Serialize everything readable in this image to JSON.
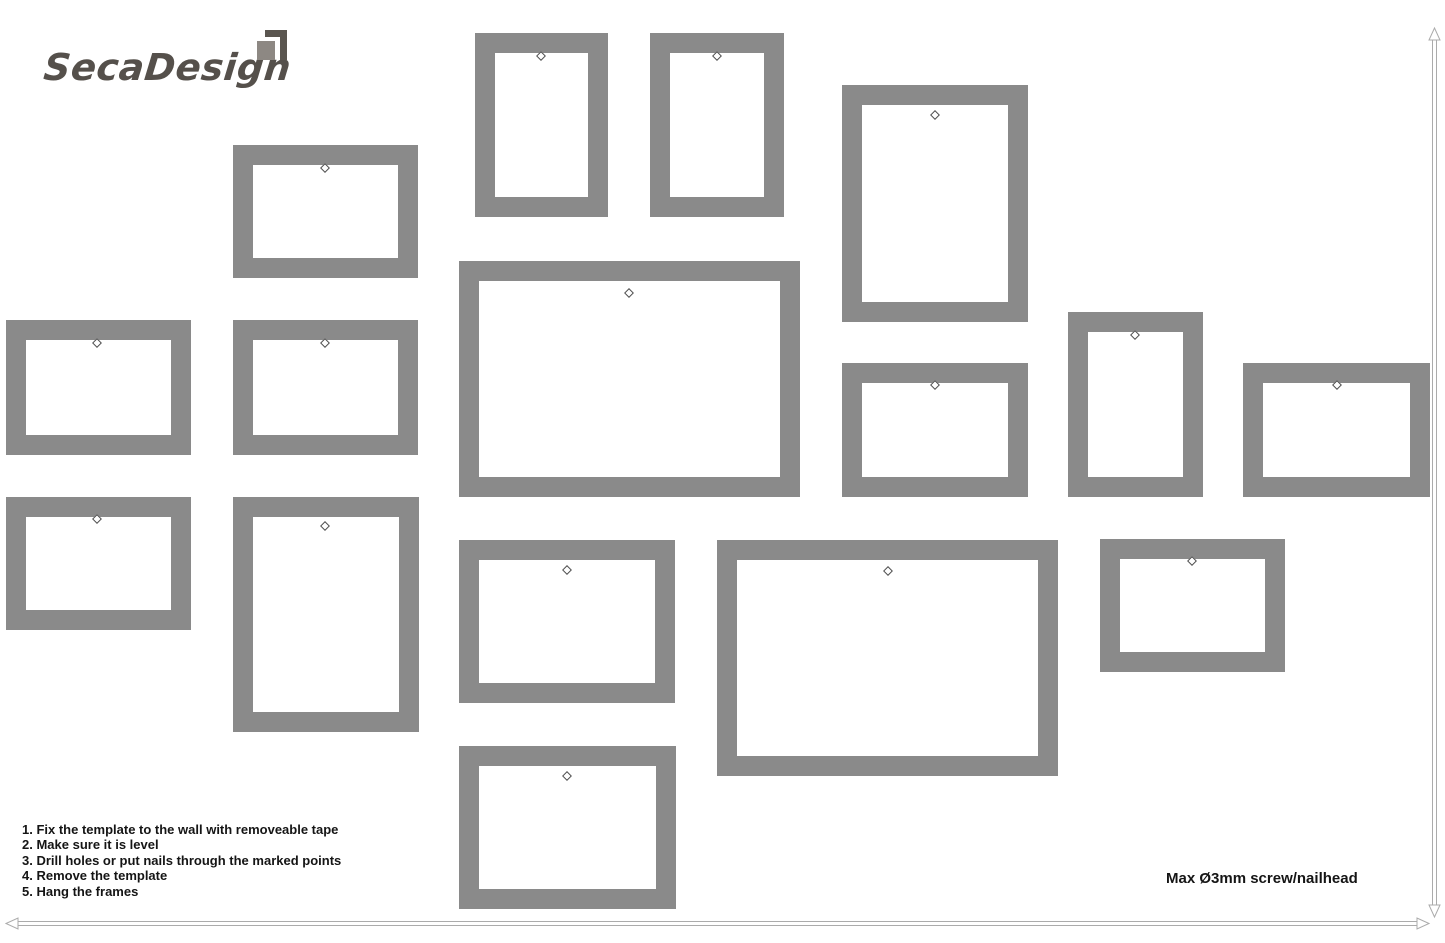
{
  "page": {
    "width": 1445,
    "height": 943,
    "background": "#ffffff"
  },
  "logo": {
    "text": "SecaDesign",
    "text_color": "#55504b",
    "icon": {
      "name": "logo-square-icon",
      "dark": "#5a554f",
      "light": "#8d8883"
    }
  },
  "instructions": {
    "items": [
      "1. Fix the template to the wall with removeable tape",
      "2. Make sure it is level",
      "3. Drill holes or put nails through the marked points",
      "4. Remove the template",
      "5. Hang the frames"
    ]
  },
  "note": {
    "text": "Max Ø3mm screw/nailhead"
  },
  "frame_style": {
    "color": "#8a8a8a",
    "border_px": 20,
    "mark_color": "#4f4f4f"
  },
  "frames": [
    {
      "id": "frame-1",
      "x": 233,
      "y": 145,
      "w": 185,
      "h": 133,
      "mark_x": 325,
      "mark_y": 168
    },
    {
      "id": "frame-2",
      "x": 475,
      "y": 33,
      "w": 133,
      "h": 184,
      "mark_x": 541,
      "mark_y": 56
    },
    {
      "id": "frame-3",
      "x": 650,
      "y": 33,
      "w": 134,
      "h": 184,
      "mark_x": 717,
      "mark_y": 56
    },
    {
      "id": "frame-4",
      "x": 842,
      "y": 85,
      "w": 186,
      "h": 237,
      "mark_x": 935,
      "mark_y": 115
    },
    {
      "id": "frame-5",
      "x": 6,
      "y": 320,
      "w": 185,
      "h": 135,
      "mark_x": 97,
      "mark_y": 343
    },
    {
      "id": "frame-6",
      "x": 233,
      "y": 320,
      "w": 185,
      "h": 135,
      "mark_x": 325,
      "mark_y": 343
    },
    {
      "id": "frame-7",
      "x": 459,
      "y": 261,
      "w": 341,
      "h": 236,
      "mark_x": 629,
      "mark_y": 293
    },
    {
      "id": "frame-8",
      "x": 842,
      "y": 363,
      "w": 186,
      "h": 134,
      "mark_x": 935,
      "mark_y": 385
    },
    {
      "id": "frame-9",
      "x": 1068,
      "y": 312,
      "w": 135,
      "h": 185,
      "mark_x": 1135,
      "mark_y": 335
    },
    {
      "id": "frame-10",
      "x": 1243,
      "y": 363,
      "w": 187,
      "h": 134,
      "mark_x": 1337,
      "mark_y": 385
    },
    {
      "id": "frame-11",
      "x": 6,
      "y": 497,
      "w": 185,
      "h": 133,
      "mark_x": 97,
      "mark_y": 519
    },
    {
      "id": "frame-12",
      "x": 233,
      "y": 497,
      "w": 186,
      "h": 235,
      "mark_x": 325,
      "mark_y": 526
    },
    {
      "id": "frame-13",
      "x": 459,
      "y": 540,
      "w": 216,
      "h": 163,
      "mark_x": 567,
      "mark_y": 570
    },
    {
      "id": "frame-14",
      "x": 717,
      "y": 540,
      "w": 341,
      "h": 236,
      "mark_x": 888,
      "mark_y": 571
    },
    {
      "id": "frame-15",
      "x": 1100,
      "y": 539,
      "w": 185,
      "h": 133,
      "mark_x": 1192,
      "mark_y": 561
    },
    {
      "id": "frame-16",
      "x": 459,
      "y": 746,
      "w": 217,
      "h": 163,
      "mark_x": 567,
      "mark_y": 776
    }
  ],
  "arrows": {
    "color": "#ababab",
    "vertical": {
      "x": 1434.5,
      "tip_top_y": 28,
      "tip_bottom_y": 917
    },
    "horizontal": {
      "y": 923.5,
      "tip_left_x": 6,
      "tip_right_x": 1429
    }
  }
}
